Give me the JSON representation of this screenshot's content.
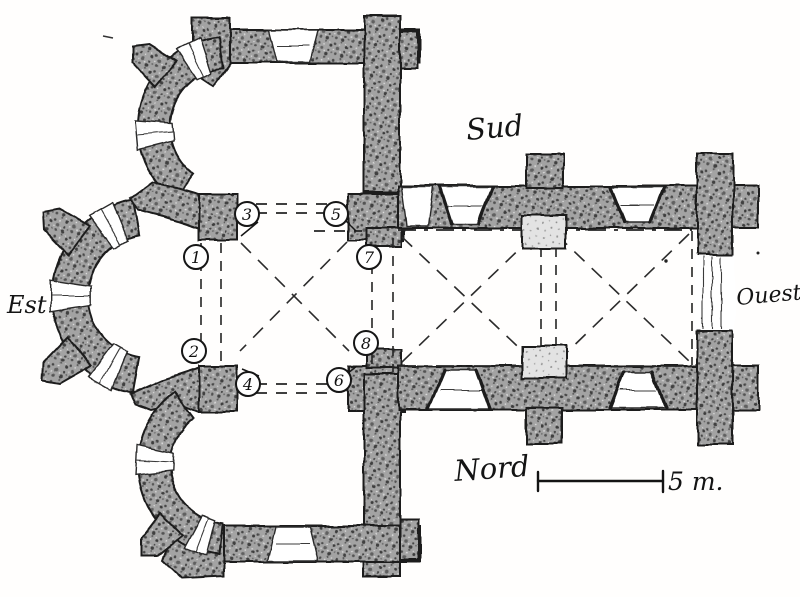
{
  "figure": {
    "kind": "hand-drawn church floor plan (pencil sketch)",
    "orientation_labels": {
      "top": "Sud",
      "bottom": "Nord",
      "left": "Est",
      "right": "Ouest"
    },
    "scale_bar": {
      "label": "5 m."
    },
    "pier_markers": [
      {
        "label": "1",
        "x": 196,
        "y": 257
      },
      {
        "label": "2",
        "x": 194,
        "y": 351
      },
      {
        "label": "3",
        "x": 247,
        "y": 214
      },
      {
        "label": "4",
        "x": 248,
        "y": 384
      },
      {
        "label": "5",
        "x": 336,
        "y": 214
      },
      {
        "label": "6",
        "x": 339,
        "y": 380
      },
      {
        "label": "7",
        "x": 369,
        "y": 257
      },
      {
        "label": "8",
        "x": 366,
        "y": 343
      }
    ],
    "colors": {
      "ink": "#1f1f1f",
      "paper": "#ffffff",
      "wall_fill": "#a3a3a3"
    }
  }
}
